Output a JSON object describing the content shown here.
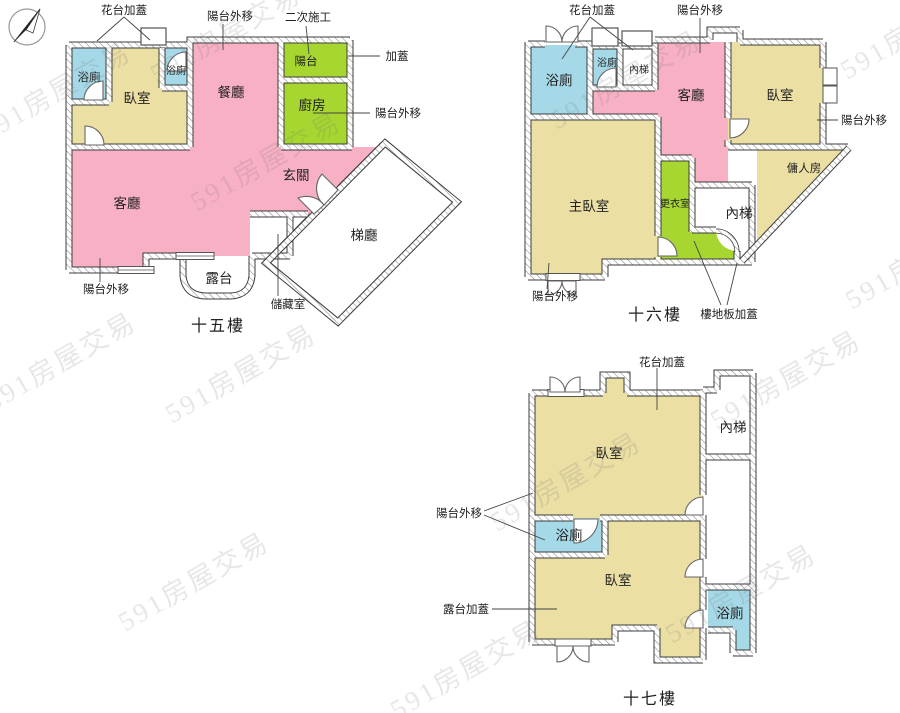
{
  "watermark": {
    "text": "591房屋交易"
  },
  "colors": {
    "pink": "#f8b0c4",
    "green": "#a7d631",
    "tan": "#ebdfa4",
    "blue": "#a5d9e7"
  },
  "f15": {
    "title": "十五樓",
    "rooms": {
      "bath1": "浴廁",
      "bedroom": "臥室",
      "bath2": "浴廁",
      "dining": "餐廳",
      "balcony": "陽台",
      "kitchen": "廚房",
      "foyer": "玄關",
      "living": "客廳",
      "stairhall": "梯廳",
      "terrace": "露台"
    },
    "labels": {
      "flower": "花台加蓋",
      "balcony_out_top": "陽台外移",
      "second_construction": "二次施工",
      "addition": "加蓋",
      "balcony_out_right": "陽台外移",
      "balcony_out_bottom": "陽台外移",
      "storage": "儲藏室"
    }
  },
  "f16": {
    "title": "十六樓",
    "rooms": {
      "bath1": "浴廁",
      "bath2": "浴廁",
      "stairs_top": "內梯",
      "living": "客廳",
      "bedroom": "臥室",
      "maid": "傭人房",
      "master": "主臥室",
      "closet": "更衣室",
      "stairs_bottom": "內梯"
    },
    "labels": {
      "flower": "花台加蓋",
      "balcony_out_top": "陽台外移",
      "balcony_out_right": "陽台外移",
      "balcony_out_bottom": "陽台外移",
      "floor_addition": "樓地板加蓋"
    }
  },
  "f17": {
    "title": "十七樓",
    "rooms": {
      "bedroom_top": "臥室",
      "stairs": "內梯",
      "bath1": "浴廁",
      "bedroom_bottom": "臥室",
      "bath2": "浴廁"
    },
    "labels": {
      "flower": "花台加蓋",
      "balcony_out": "陽台外移",
      "terrace_addition": "露台加蓋"
    }
  }
}
